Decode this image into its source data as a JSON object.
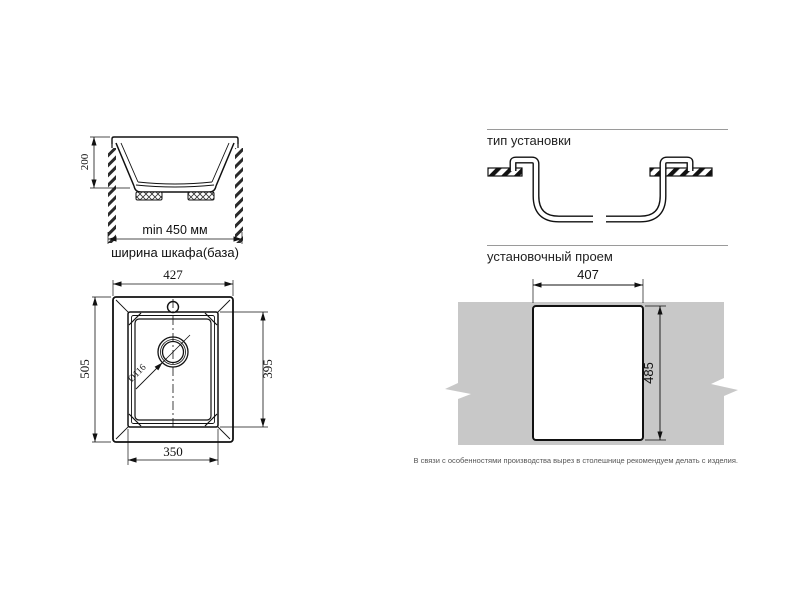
{
  "cabinet_section": {
    "height_dim": "200",
    "min_width_dim": "min 450 мм",
    "cabinet_width_label": "ширина шкафа(база)"
  },
  "installation_type": {
    "title": "тип установки"
  },
  "top_view": {
    "overall_width_dim": "427",
    "overall_depth_dim": "505",
    "bowl_depth_dim": "395",
    "bowl_width_dim": "350",
    "drain_dim": "Ø116"
  },
  "cutout": {
    "title": "установочный проем",
    "width_dim": "407",
    "height_dim": "485",
    "note": "В связи с особенностями производства вырез в столешнице рекомендуем делать с изделия."
  },
  "colors": {
    "line": "#1a1a1a",
    "countertop_gray": "#c8c8c8",
    "header_rule": "#9a9a9a"
  }
}
